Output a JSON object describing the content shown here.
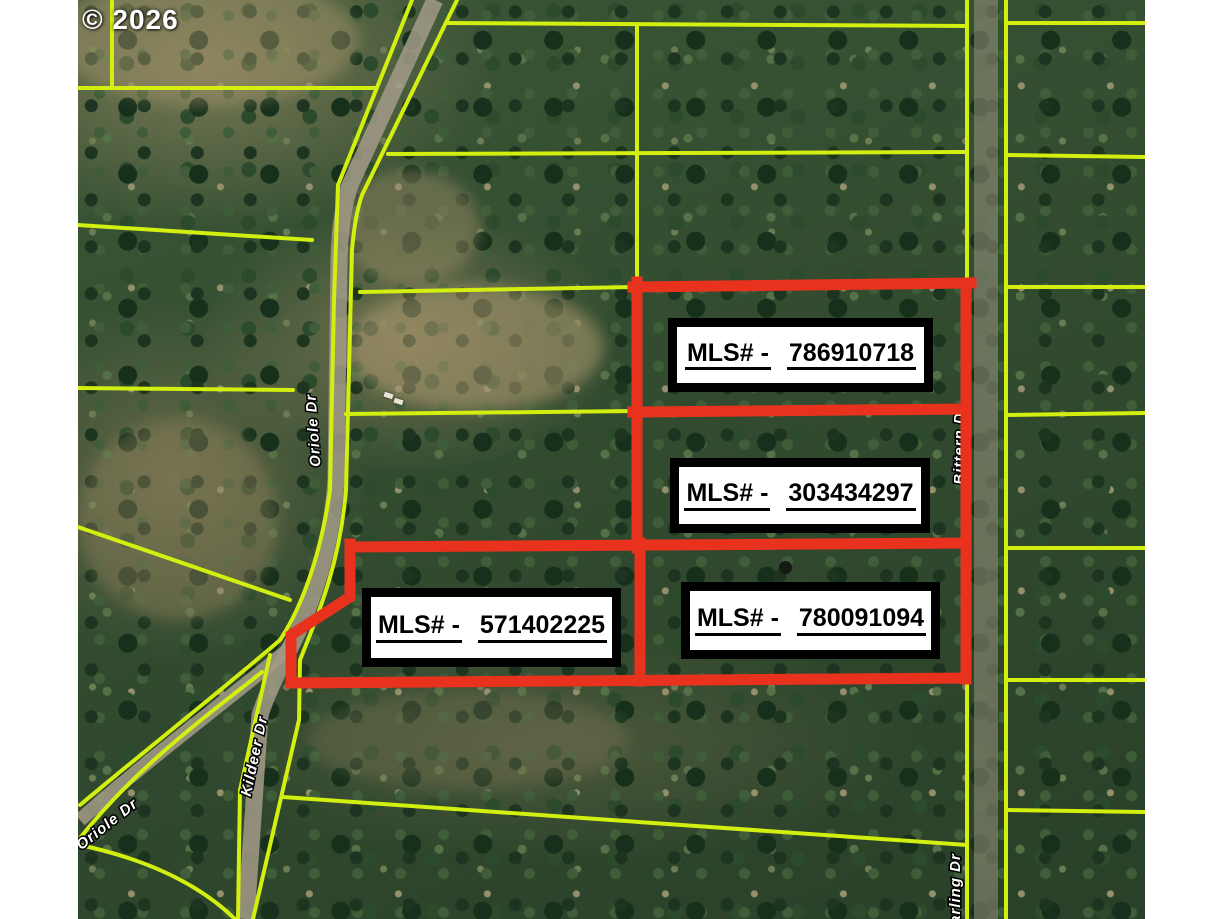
{
  "copyright": "© 2026",
  "mls_labels": [
    {
      "prefix": "MLS# -",
      "number": "786910718"
    },
    {
      "prefix": "MLS# -",
      "number": "303434297"
    },
    {
      "prefix": "MLS# -",
      "number": "571402225"
    },
    {
      "prefix": "MLS# -",
      "number": "780091094"
    }
  ],
  "streets": [
    {
      "name": "Oriole Dr"
    },
    {
      "name": "Kildeer Dr"
    },
    {
      "name": "Oriole Dr"
    },
    {
      "name": "Bittern Dr"
    },
    {
      "name": "Starling Dr"
    }
  ],
  "colors": {
    "parcel_line": "#d3ef10",
    "highlight_outline": "#e8321e",
    "label_border": "#000000",
    "label_background": "#ffffff",
    "label_text": "#000000",
    "road": "#a39b88",
    "forest": "#385234"
  }
}
